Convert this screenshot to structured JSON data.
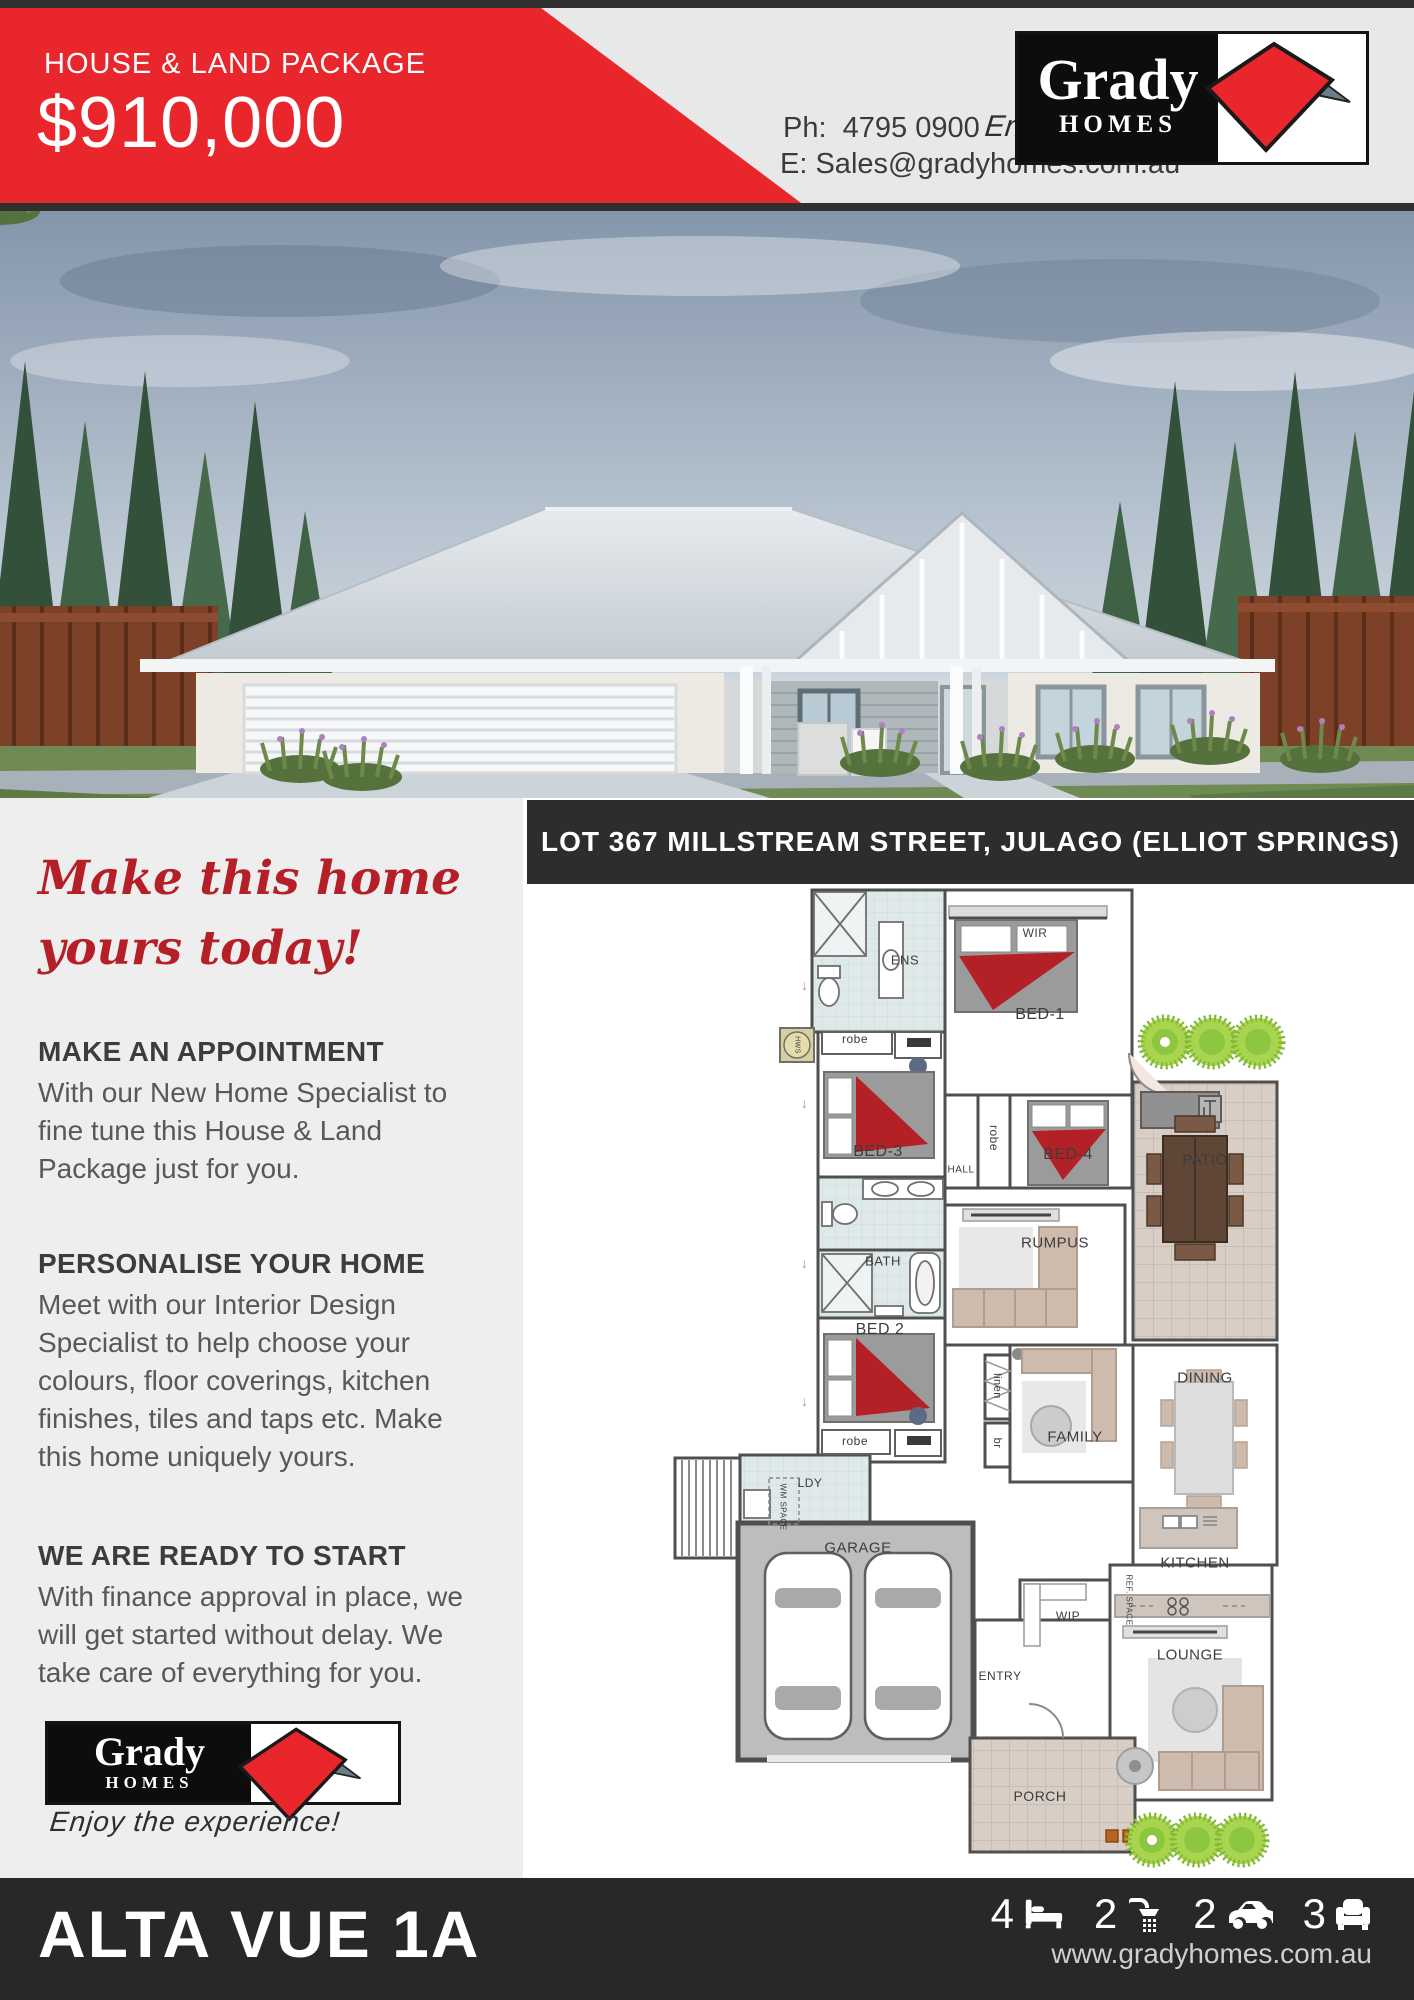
{
  "header": {
    "eyebrow": "HOUSE & LAND PACKAGE",
    "price": "$910,000",
    "phone_label": "Ph:",
    "phone": "4795 0900",
    "email_label": "E:",
    "email": "Sales@gradyhomes.com.au",
    "tagline": "Enjoy the experience!"
  },
  "logo": {
    "name": "Grady",
    "sub": "HOMES"
  },
  "colors": {
    "accent_red": "#e8262c",
    "headline_red": "#b51f28",
    "dark_bar": "#2d2d2d",
    "left_bg": "#eeeeee",
    "tree_green": "#8dc63f"
  },
  "left_column": {
    "headline_line1": "Make this home",
    "headline_line2": "yours today!",
    "sections": [
      {
        "heading": "MAKE AN APPOINTMENT",
        "body": "With our New Home Specialist to fine tune this House & Land Package just for you."
      },
      {
        "heading": "PERSONALISE YOUR HOME",
        "body": "Meet with our Interior Design Specialist to help choose your colours, floor coverings, kitchen finishes, tiles and taps etc. Make this home uniquely yours."
      },
      {
        "heading": "WE ARE READY TO START",
        "body": "With finance approval in place, we will get started without delay. We take care of everything for you."
      }
    ],
    "tagline": "Enjoy the experience!"
  },
  "plan": {
    "address": "LOT 367 MILLSTREAM STREET, JULAGO (ELLIOT SPRINGS)",
    "labels": [
      {
        "text": "ENS",
        "x": 382,
        "y": 74,
        "size": 13
      },
      {
        "text": "WIR",
        "x": 512,
        "y": 47,
        "size": 12
      },
      {
        "text": "BED-1",
        "x": 517,
        "y": 129,
        "size": 16
      },
      {
        "text": "robe",
        "x": 332,
        "y": 153,
        "size": 12
      },
      {
        "text": "BED-3",
        "x": 355,
        "y": 266,
        "size": 16
      },
      {
        "text": "HALL",
        "x": 438,
        "y": 284,
        "size": 10
      },
      {
        "text": "robe",
        "x": 471,
        "y": 252,
        "size": 12,
        "rot": 90
      },
      {
        "text": "BED-4",
        "x": 545,
        "y": 269,
        "size": 16
      },
      {
        "text": "PATIO",
        "x": 682,
        "y": 274,
        "size": 15
      },
      {
        "text": "RUMPUS",
        "x": 532,
        "y": 357,
        "size": 15
      },
      {
        "text": "BATH",
        "x": 360,
        "y": 375,
        "size": 13
      },
      {
        "text": "BED 2",
        "x": 357,
        "y": 444,
        "size": 16
      },
      {
        "text": "linen",
        "x": 474,
        "y": 500,
        "size": 11,
        "rot": 90
      },
      {
        "text": "br",
        "x": 474,
        "y": 557,
        "size": 11,
        "rot": 90
      },
      {
        "text": "FAMILY",
        "x": 552,
        "y": 551,
        "size": 15
      },
      {
        "text": "DINING",
        "x": 682,
        "y": 492,
        "size": 15
      },
      {
        "text": "robe",
        "x": 332,
        "y": 555,
        "size": 12
      },
      {
        "text": "LDY",
        "x": 287,
        "y": 597,
        "size": 12
      },
      {
        "text": "WM SPACE",
        "x": 260,
        "y": 621,
        "size": 8,
        "rot": 90
      },
      {
        "text": "GARAGE",
        "x": 335,
        "y": 662,
        "size": 15
      },
      {
        "text": "WIP",
        "x": 545,
        "y": 730,
        "size": 12
      },
      {
        "text": "KITCHEN",
        "x": 672,
        "y": 677,
        "size": 15
      },
      {
        "text": "REF. SPACE",
        "x": 606,
        "y": 714,
        "size": 8,
        "rot": 90
      },
      {
        "text": "ENTRY",
        "x": 477,
        "y": 790,
        "size": 12
      },
      {
        "text": "LOUNGE",
        "x": 667,
        "y": 769,
        "size": 15
      },
      {
        "text": "PORCH",
        "x": 517,
        "y": 910,
        "size": 14
      },
      {
        "text": "HWS",
        "x": 274,
        "y": 159,
        "size": 7,
        "rot": 90
      }
    ]
  },
  "footer": {
    "title": "ALTA VUE 1A",
    "website": "www.gradyhomes.com.au",
    "stats": [
      {
        "icon": "bed-icon",
        "value": "4"
      },
      {
        "icon": "shower-icon",
        "value": "2"
      },
      {
        "icon": "car-icon",
        "value": "2"
      },
      {
        "icon": "sofa-icon",
        "value": "3"
      }
    ]
  }
}
